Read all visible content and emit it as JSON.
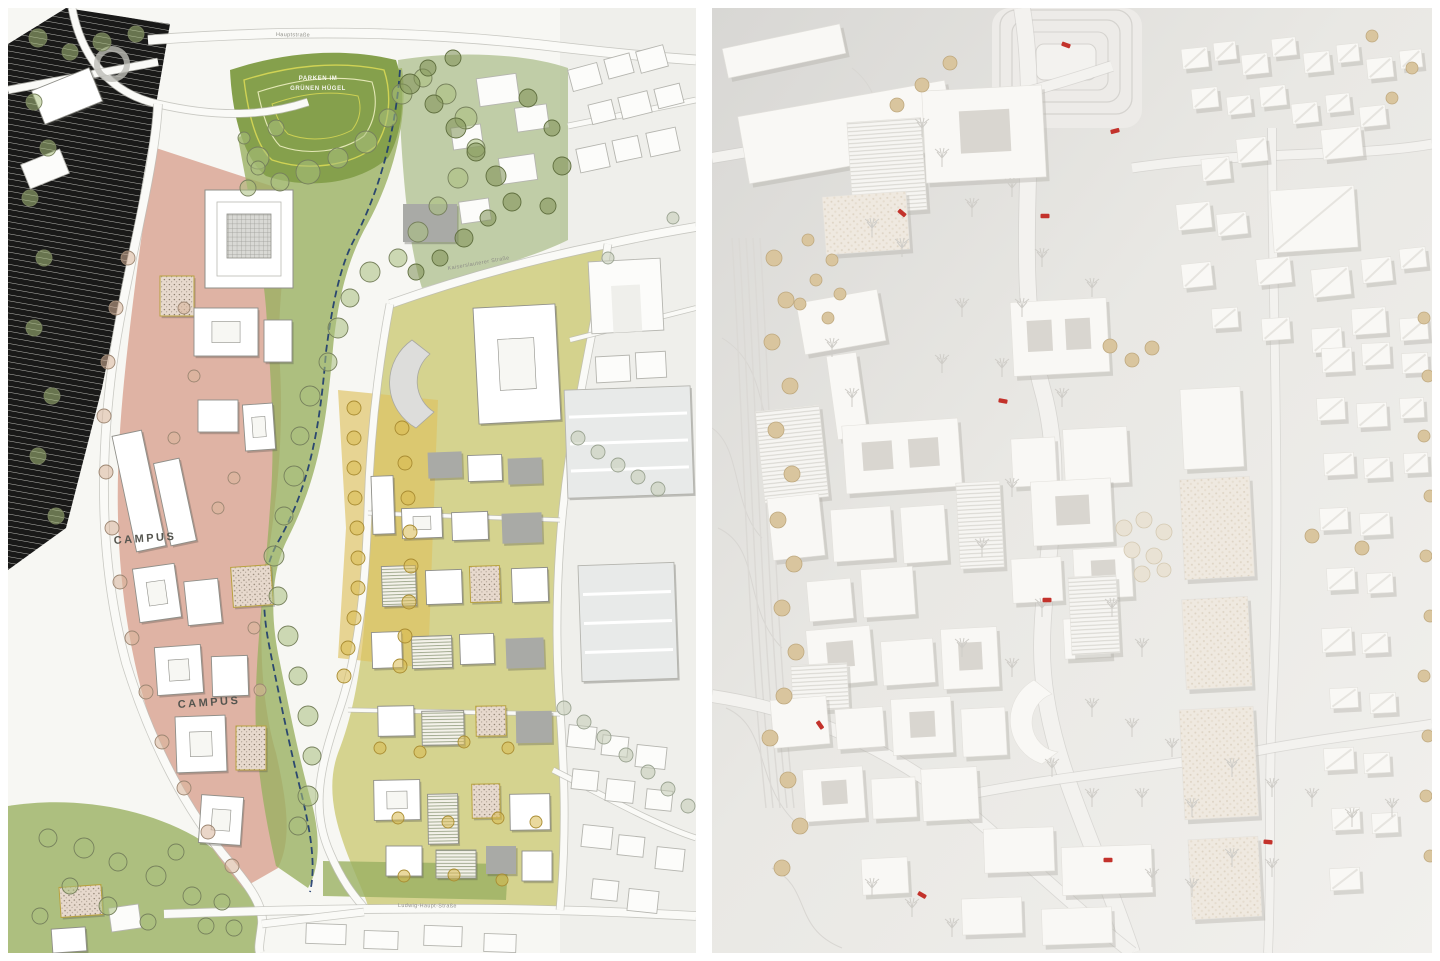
{
  "board": {
    "background": "#ffffff"
  },
  "site_plan": {
    "labels": {
      "campus_upper": "CAMPUS",
      "campus_lower": "CAMPUS",
      "green_hill_line1": "PARKEN IM",
      "green_hill_line2": "GRÜNEN HÜGEL",
      "street_top": "Hauptstraße",
      "street_east": "Kaiserslauterer Straße",
      "street_south": "Ludwig-Haupt-Straße"
    },
    "palette": {
      "paper": "#f7f7f3",
      "existing_city": "#efefeb",
      "campus_zone": "#dba795",
      "housing_zone": "#cfcd7c",
      "plaza_yellow": "#dfc25f",
      "park_green": "#9ab061",
      "hill_green": "#85a04c",
      "garden_green": "#aebf8d",
      "tree_green": "#a9c07d",
      "tree_yellow": "#d9ba4e",
      "tree_tan": "#d8b49b",
      "tree_olive": "#7e8f54",
      "tree_pale": "#c2cbb4",
      "stream_blue": "#1d3a6e",
      "road_fill": "#fafaf7",
      "road_casing": "#bdbdb7",
      "rail_line": "#a8a8a2",
      "building_white": "#ffffff",
      "building_outline": "#8f8f89",
      "building_gray": "#a9aaa6"
    }
  },
  "model_photo": {
    "palette": {
      "ground_light": "#efeeea",
      "ground_dark": "#d8d7d4",
      "building_top": "#f9f8f5",
      "building_shadow": "#b3b0a9",
      "building_inset": "#d9d6d0",
      "stripe_line": "#d7d5cf",
      "tree_beige": "#d9c59e",
      "tree_pale": "#e9e2d4",
      "tree_wire": "#cfcdc8",
      "road_line": "#c8c6c2",
      "car_red": "#c3322b"
    }
  }
}
